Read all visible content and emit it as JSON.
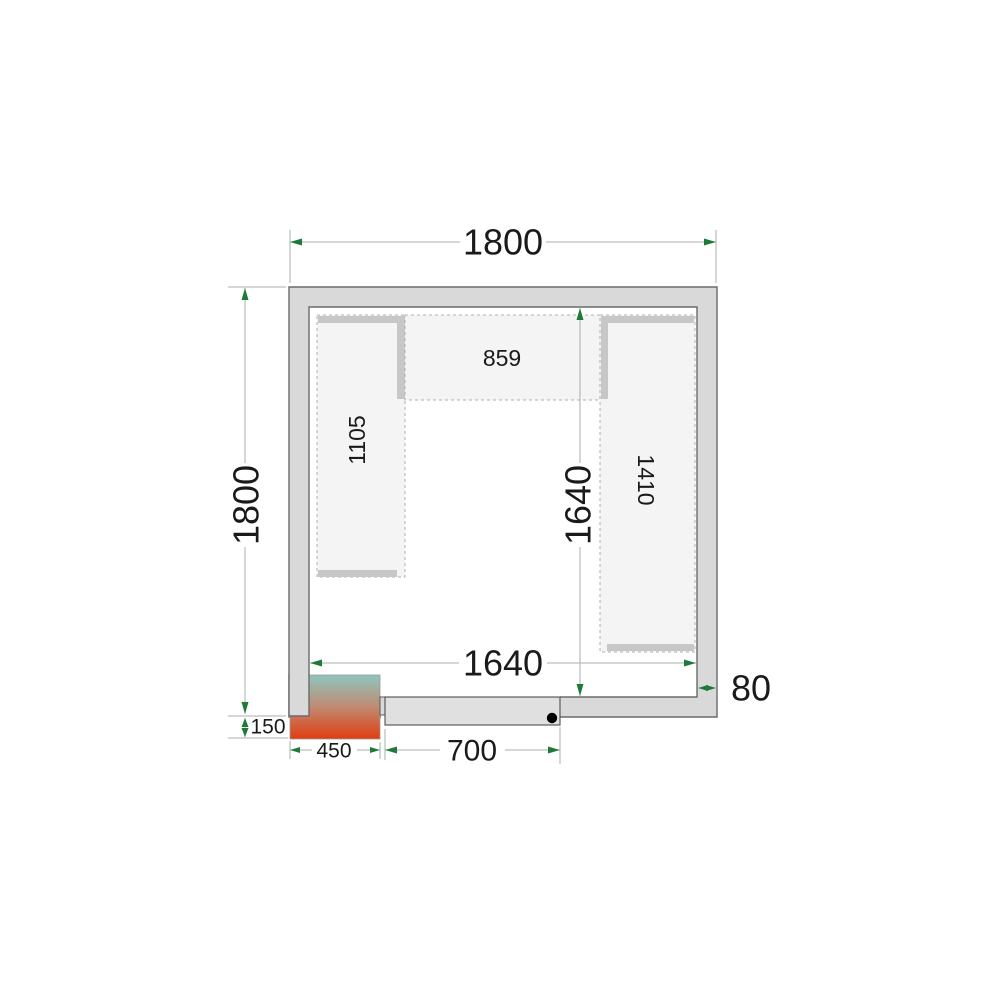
{
  "drawing": {
    "title": "Cold room floor plan - top view",
    "dimensions": {
      "overall_width": "1800",
      "overall_depth": "1800",
      "inner_width": "1640",
      "inner_depth": "1640",
      "wall_thickness": "80",
      "condenser_offset": "150",
      "condenser_width": "450",
      "door_width": "700"
    },
    "shelving": {
      "left_shelf": "1105",
      "back_shelf": "859",
      "right_shelf": "1410"
    },
    "colors": {
      "wall_fill": "#d9d9d9",
      "wall_stroke": "#6a6a6a",
      "shelf_fill": "#f4f4f4",
      "shelf_bar": "#c7c7c7",
      "dim_line": "#a8b0a8",
      "arrow_green": "#1f7a38",
      "label_color": "#1a1a1a",
      "door_fill": "#e0e0e0",
      "door_stroke": "#4f4f4f",
      "door_handle": "#000000",
      "condenser_top": "#8ec6bd",
      "condenser_mid": "#c08a72",
      "condenser_bottom": "#e03c0f"
    }
  }
}
